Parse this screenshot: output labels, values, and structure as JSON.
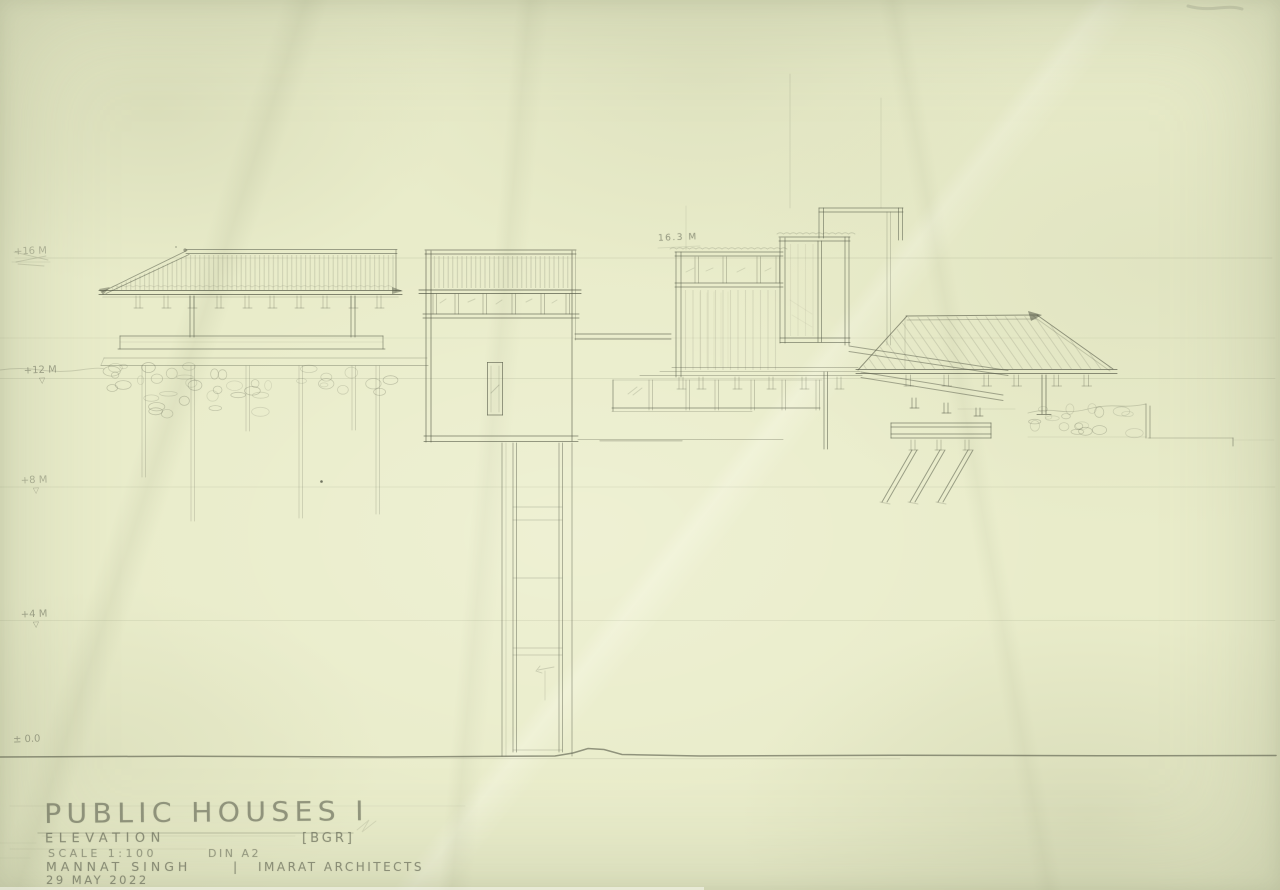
{
  "sheet": {
    "paper_color": "#e9ecca",
    "pencil_color": "#63664f"
  },
  "title_block": {
    "title": "PUBLIC HOUSES I",
    "drawing_type": "ELEVATION",
    "tag": "[BGR]",
    "scale": "SCALE 1:100",
    "sheet_size": "DIN A2",
    "author": "MANNAT SINGH",
    "separator": "|",
    "firm": "IMARAT ARCHITECTS",
    "date": "29 MAY 2022"
  },
  "elevation_markers": [
    {
      "label": "+16 M",
      "datum_symbol": ""
    },
    {
      "label": "+12 M",
      "datum_symbol": "▽"
    },
    {
      "label": "+8 M",
      "datum_symbol": "▽"
    },
    {
      "label": "+4 M",
      "datum_symbol": "▽"
    },
    {
      "label": "± 0.0",
      "datum_symbol": ""
    }
  ],
  "annotations": [
    {
      "text": "16.3 M"
    }
  ]
}
